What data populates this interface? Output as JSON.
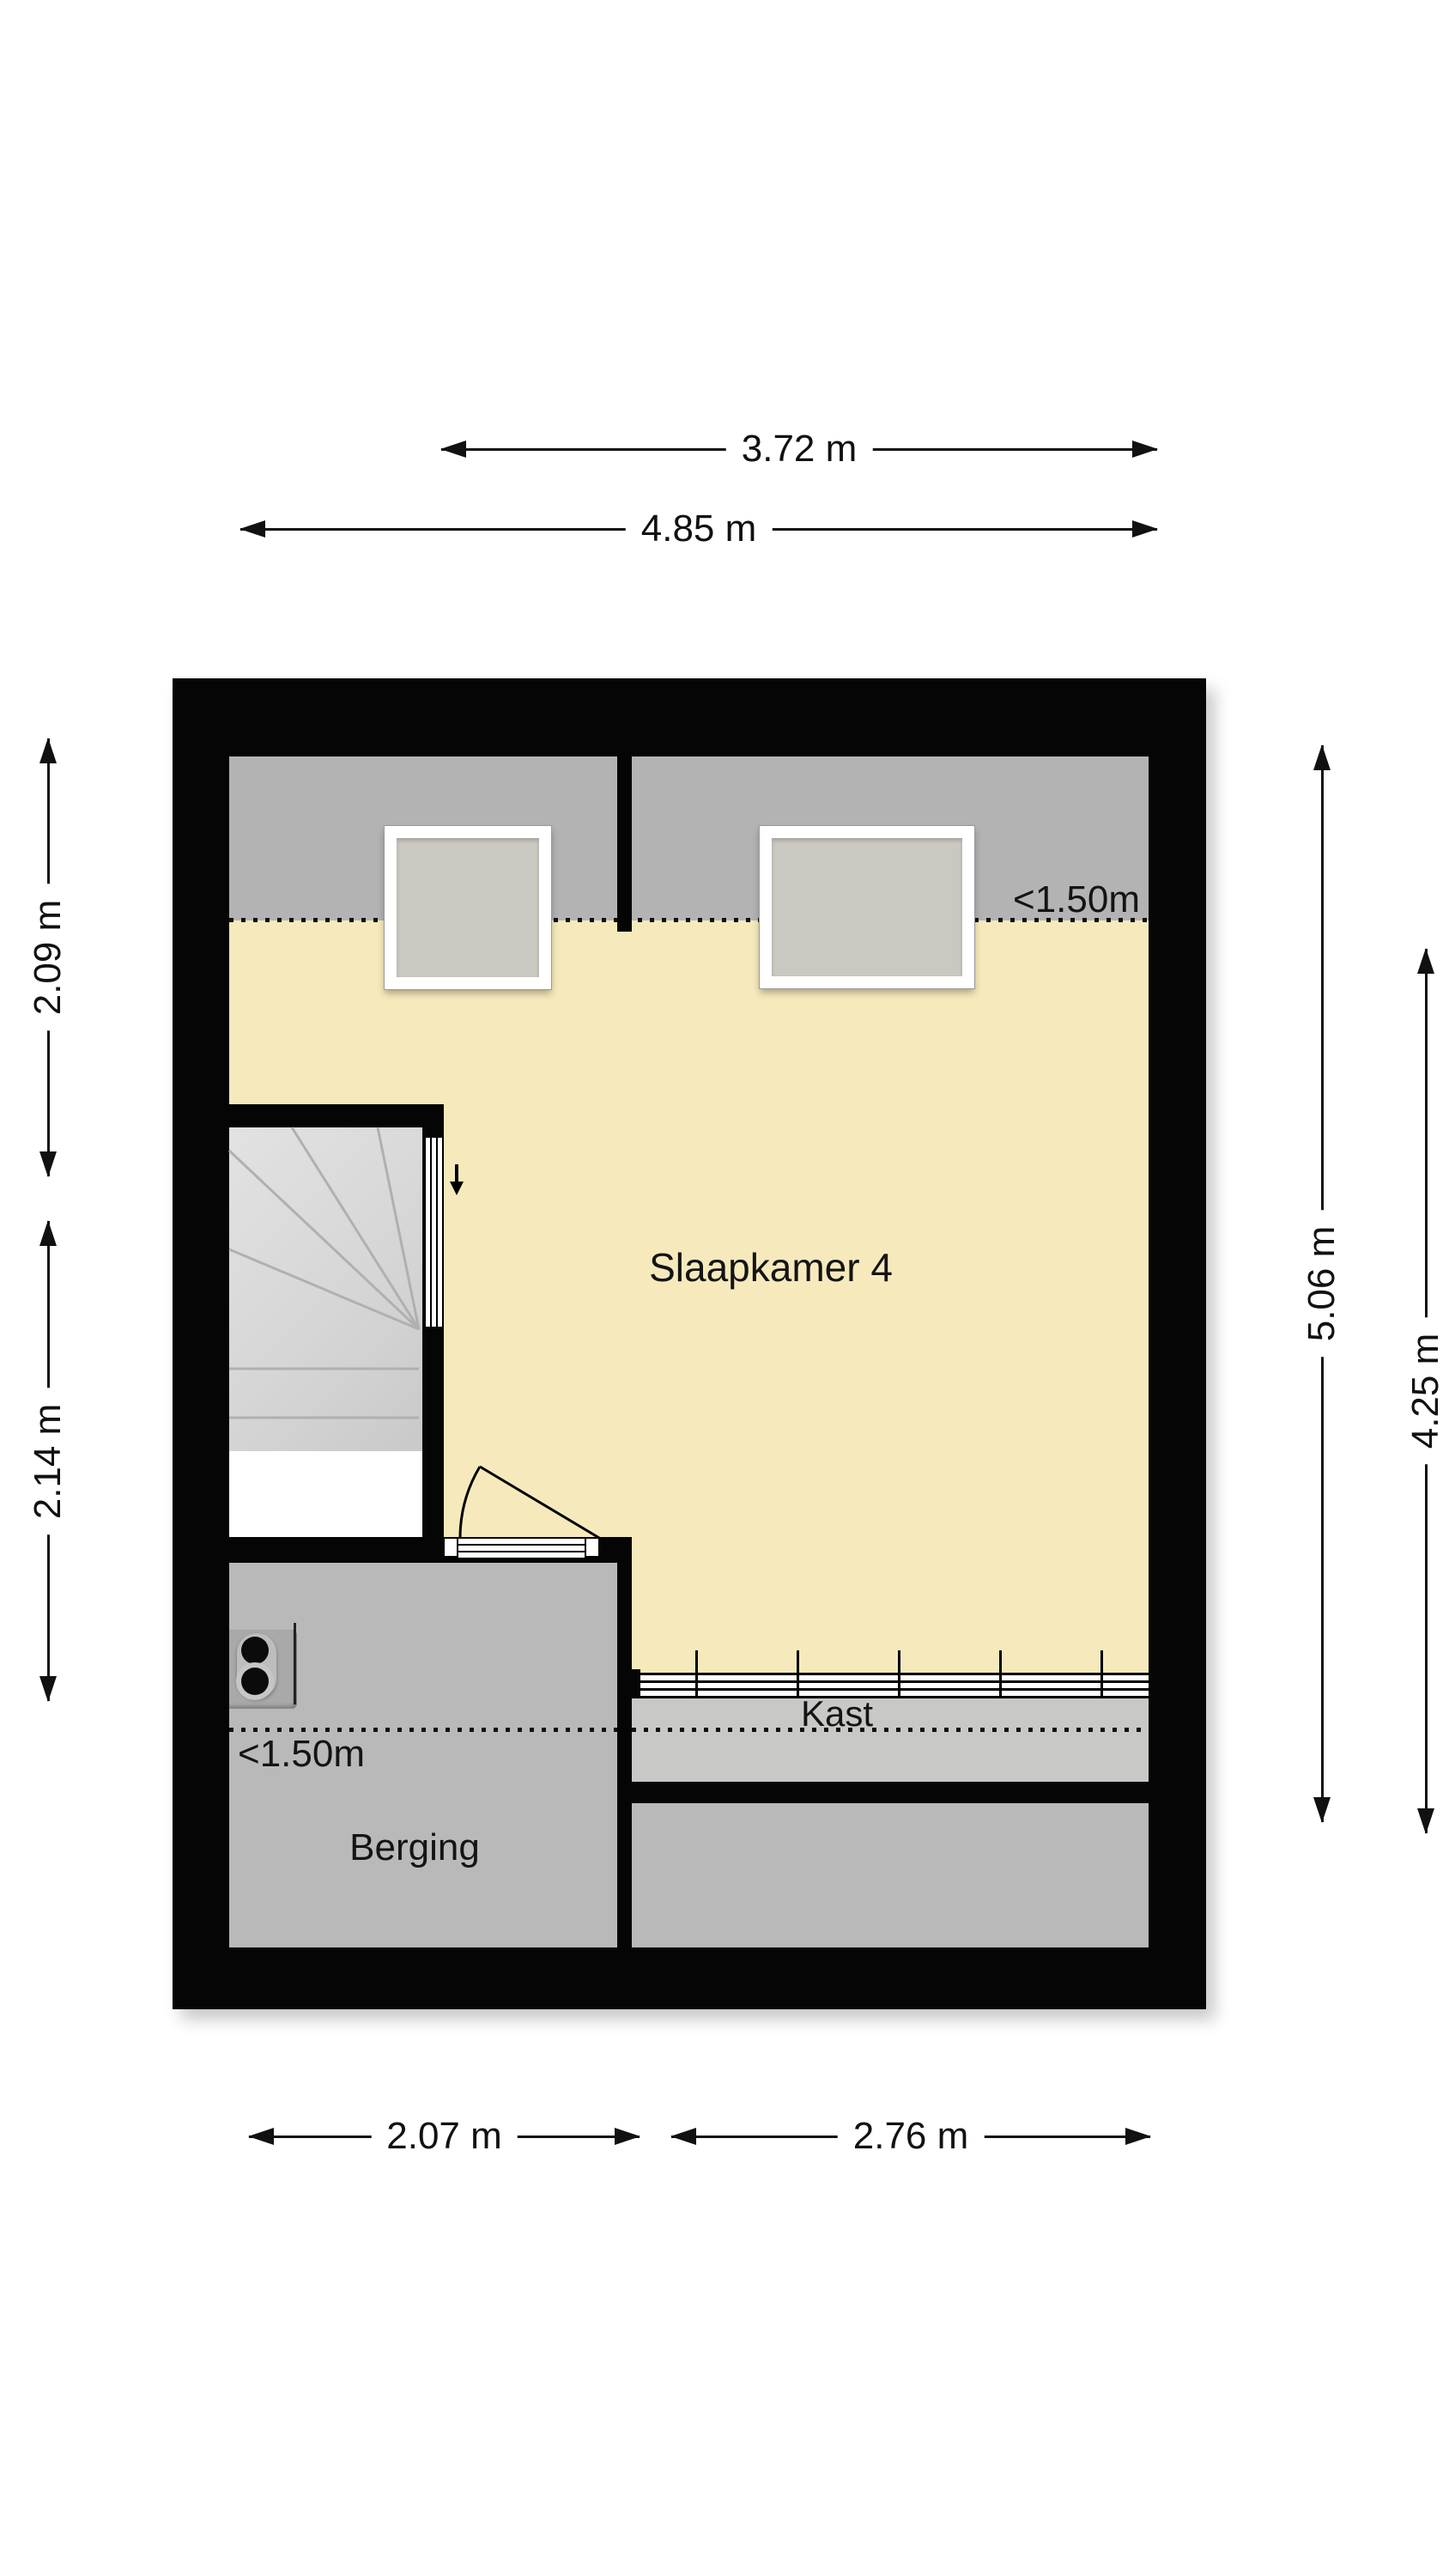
{
  "plan": {
    "rooms": {
      "slaapkamer": {
        "label": "Slaapkamer 4"
      },
      "berging": {
        "label": "Berging"
      },
      "kast": {
        "label": "Kast"
      }
    },
    "annotations": {
      "low_height_top": "<1.50m",
      "low_height_berging": "<1.50m"
    }
  },
  "dimensions": {
    "top": [
      {
        "label": "3.72 m"
      },
      {
        "label": "4.85 m"
      }
    ],
    "bottom": [
      {
        "label": "2.07 m"
      },
      {
        "label": "2.76 m"
      }
    ],
    "left": [
      {
        "label": "2.09 m"
      },
      {
        "label": "2.14 m"
      }
    ],
    "right": [
      {
        "label": "5.06 m"
      },
      {
        "label": "4.25 m"
      }
    ]
  },
  "colors": {
    "wall": "#050505",
    "room_yellow": "#f6eabc",
    "zone_gray": "#b3b3b3",
    "room_gray": "#b9b9b9",
    "kast_gray": "#c8c8c6",
    "stairs_gray": "#dcdcdc",
    "window_pane": "#cac8c1"
  }
}
